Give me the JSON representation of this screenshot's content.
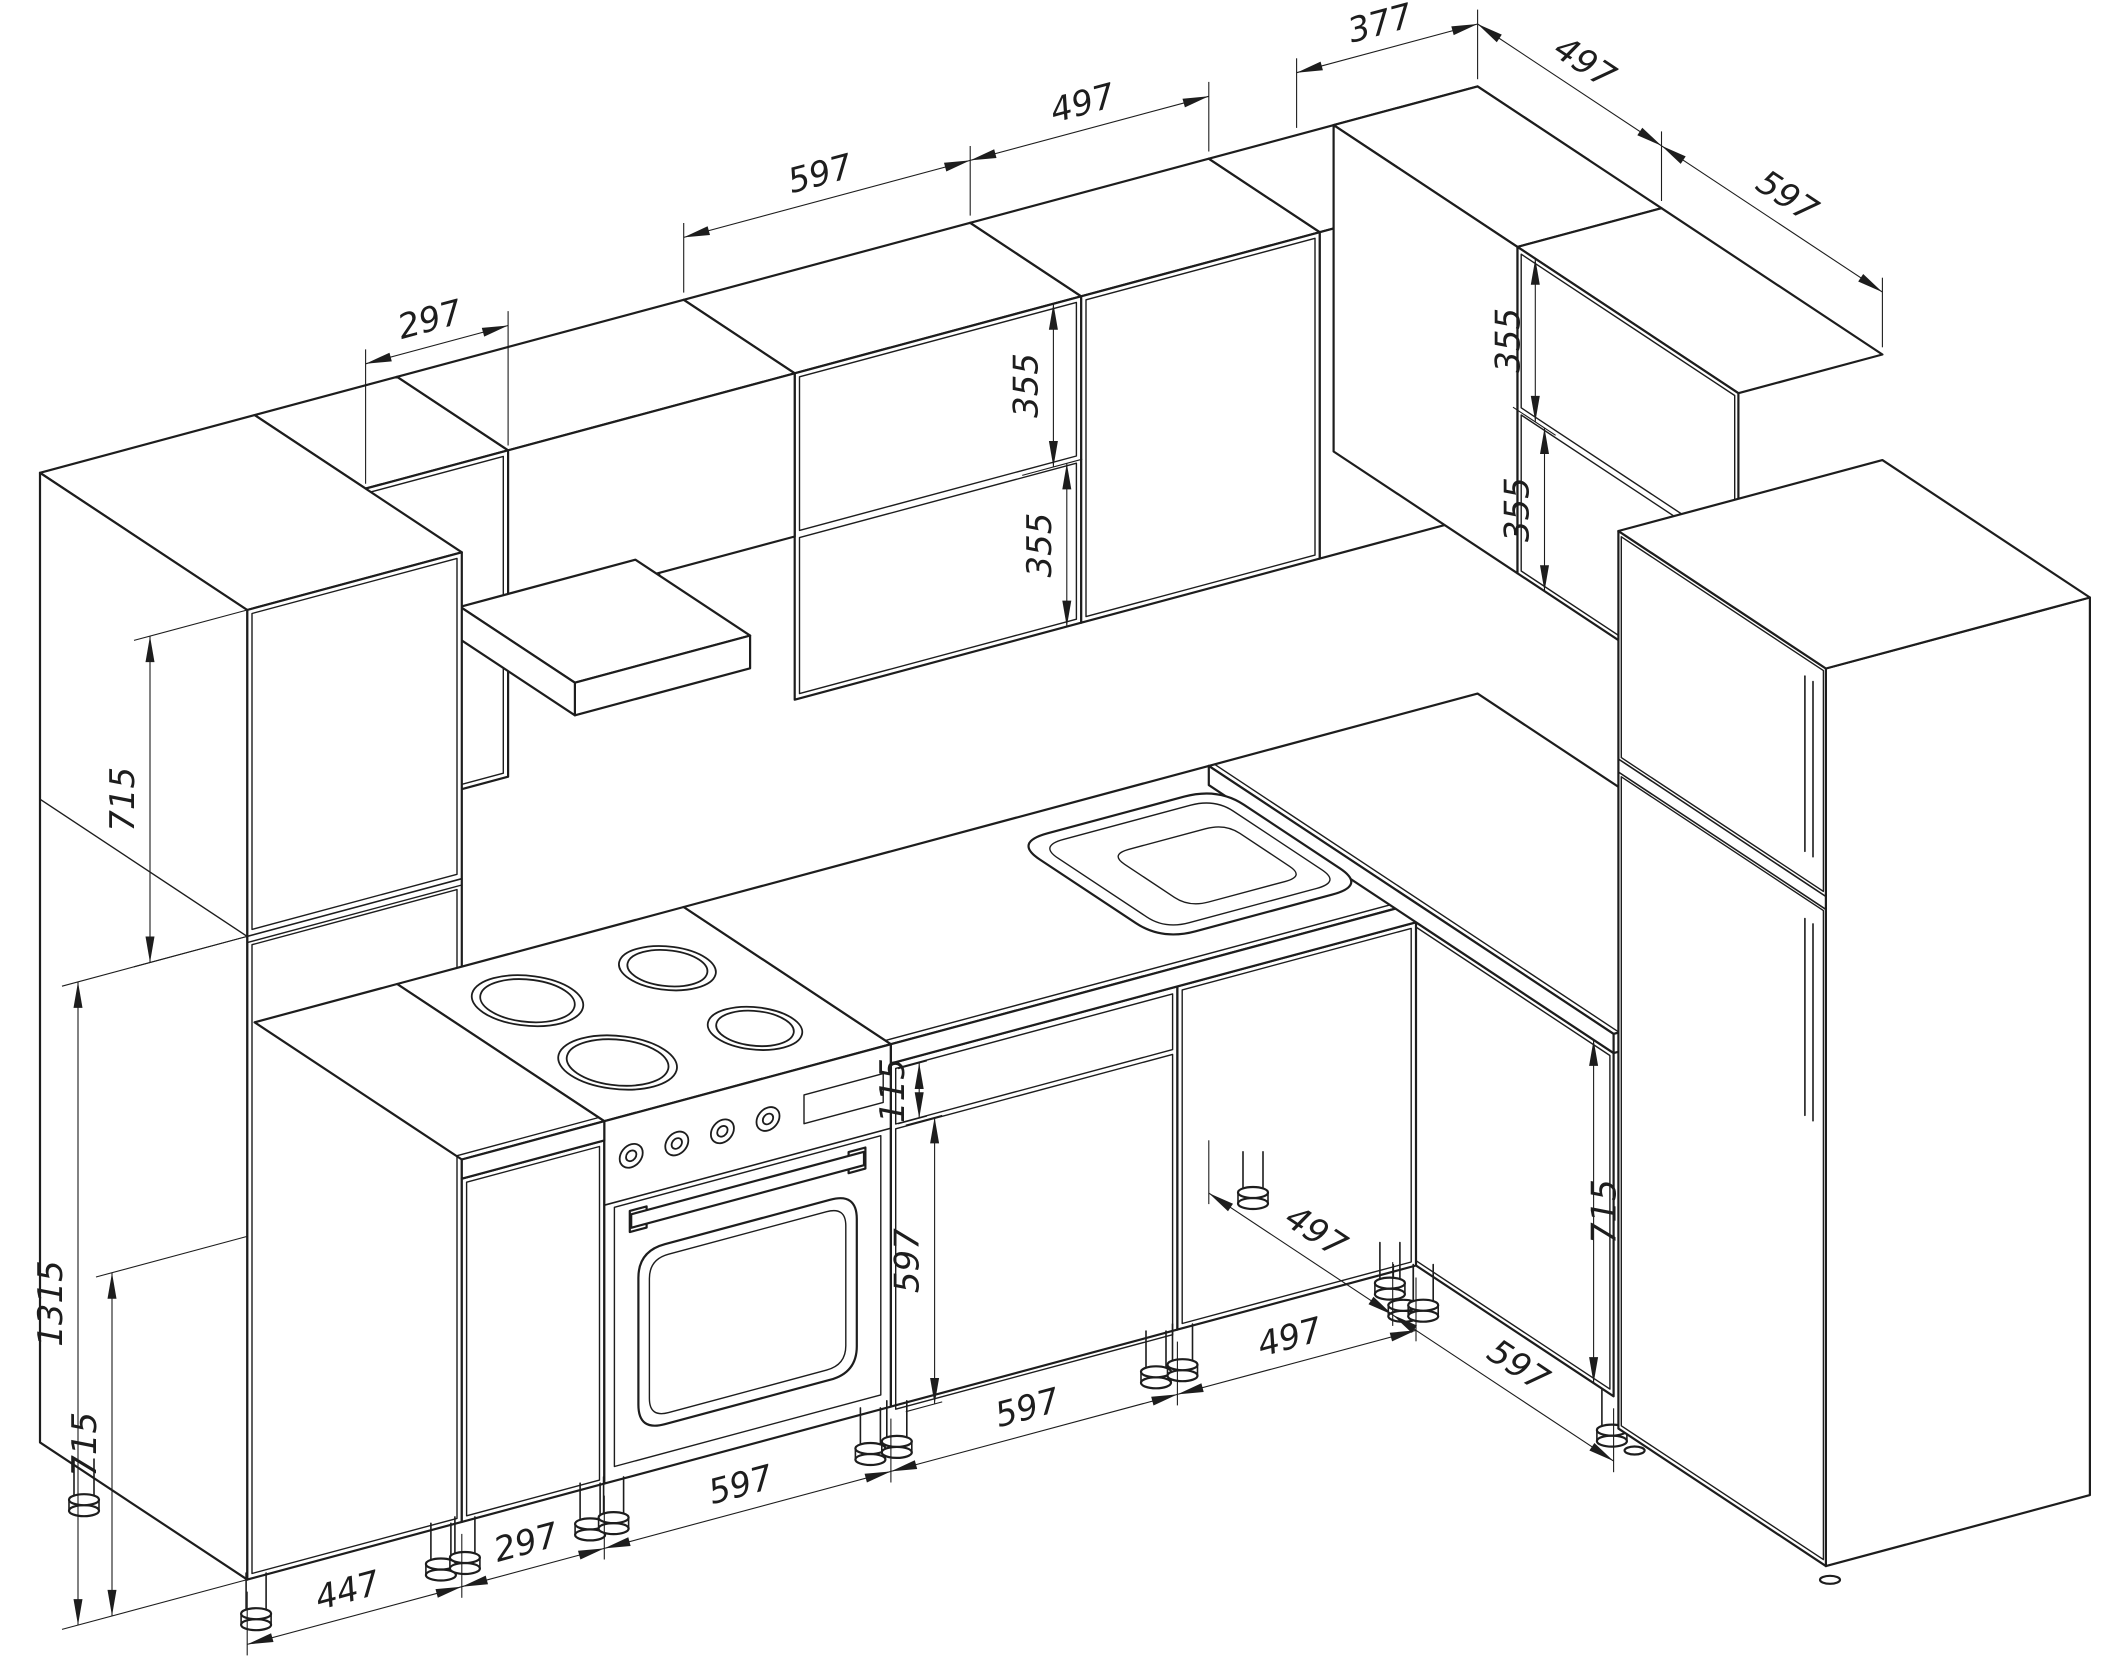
{
  "drawing": {
    "type": "kitchen-isometric-technical-drawing",
    "line_color": "#1d1d1d",
    "background_color": "#ffffff"
  },
  "dimensions": [
    {
      "id": "upper-cabinet-center-width",
      "value": "597"
    },
    {
      "id": "upper-cabinet-right-width",
      "value": "497"
    },
    {
      "id": "upper-corner-top-width",
      "value": "377"
    },
    {
      "id": "right-upper-corner-width",
      "value": "497"
    },
    {
      "id": "right-upper-cabinet-width",
      "value": "597"
    },
    {
      "id": "upper-cabinet-left-width",
      "value": "297"
    },
    {
      "id": "upper-door-top-height",
      "value": "355"
    },
    {
      "id": "upper-door-bottom-height",
      "value": "355"
    },
    {
      "id": "right-upper-door-top-height",
      "value": "355"
    },
    {
      "id": "right-upper-door-bottom-height",
      "value": "355"
    },
    {
      "id": "tall-cabinet-upper-section-height",
      "value": "715"
    },
    {
      "id": "tall-cabinet-lower-section-height",
      "value": "1315"
    },
    {
      "id": "base-cabinet-height",
      "value": "715"
    },
    {
      "id": "drawer-front-height",
      "value": "115"
    },
    {
      "id": "base-door-height",
      "value": "597"
    },
    {
      "id": "tall-cabinet-width",
      "value": "447"
    },
    {
      "id": "narrow-base-cabinet-width",
      "value": "297"
    },
    {
      "id": "stove-width",
      "value": "597"
    },
    {
      "id": "dishwasher-cabinet-width",
      "value": "597"
    },
    {
      "id": "sink-base-width",
      "value": "497"
    },
    {
      "id": "corner-base-depth",
      "value": "497"
    },
    {
      "id": "right-base-cabinet-width",
      "value": "597"
    },
    {
      "id": "right-base-door-height",
      "value": "715"
    }
  ]
}
